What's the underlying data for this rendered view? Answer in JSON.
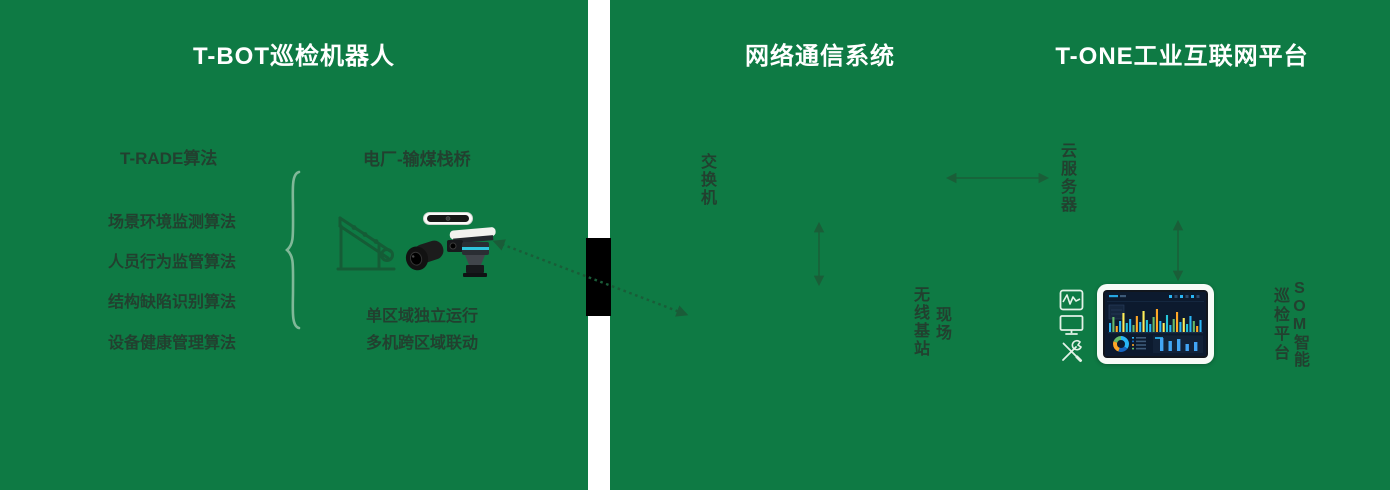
{
  "sections": {
    "robot": {
      "title": "T-BOT巡检机器人",
      "algorithms_heading": "T-RADE算法",
      "algorithms": [
        "场景环境监测算法",
        "人员行为监管算法",
        "结构缺陷识别算法",
        "设备健康管理算法"
      ],
      "scene_label": "电厂-输煤栈桥",
      "mode_lines": [
        "单区域独立运行",
        "多机跨区域联动"
      ]
    },
    "network": {
      "title": "网络通信系统",
      "switch_label": "交换机",
      "site_label": "现场",
      "base_station_label": "无线基站"
    },
    "platform": {
      "title": "T-ONE工业互联网平台",
      "cloud_server_label": "云服务器",
      "som_label_right_column": "SOM智能",
      "som_label_left_column": "巡检平台"
    }
  },
  "icons": {
    "scene_icon": "conveyor-bridge",
    "device_images": [
      "sensor-bar",
      "ptz-camera",
      "rail-inspection-robot"
    ],
    "platform_icon_stack": [
      "waveform-monitor",
      "display-screen",
      "maintenance-tools"
    ]
  },
  "colors": {
    "panel_bg": "#0e7a44",
    "title_text": "#ffffff",
    "label_text": "#22402f",
    "arrow": "#1a5e38",
    "dotted_link": "#1a5c38",
    "brace": "#80b898",
    "icon_outline": "#e3f2e7",
    "connector_block": "#000000",
    "tablet_frame": "#f7fbf7",
    "screen_bg": "#0c1a2e"
  },
  "tablet_dashboard": {
    "main_bar_heights": [
      9,
      15,
      6,
      11,
      19,
      9,
      13,
      7,
      16,
      10,
      21,
      12,
      8,
      15,
      23,
      11,
      9,
      17,
      7,
      13,
      20,
      10,
      14,
      8,
      16,
      11,
      6,
      12
    ],
    "main_bar_colors": [
      "#29b6f6",
      "#66bb6a",
      "#ffa726",
      "#29b6f6",
      "#ffee58",
      "#26c6da"
    ],
    "bottom_bar_heights": [
      13,
      10,
      12,
      7,
      9
    ],
    "bottom_bar_color": "#42a5f5",
    "donut_segments": [
      {
        "color": "#29b6f6",
        "value": 35
      },
      {
        "color": "#1565c0",
        "value": 20
      },
      {
        "color": "#ffa726",
        "value": 25
      },
      {
        "color": "#66bb6a",
        "value": 20
      }
    ]
  }
}
